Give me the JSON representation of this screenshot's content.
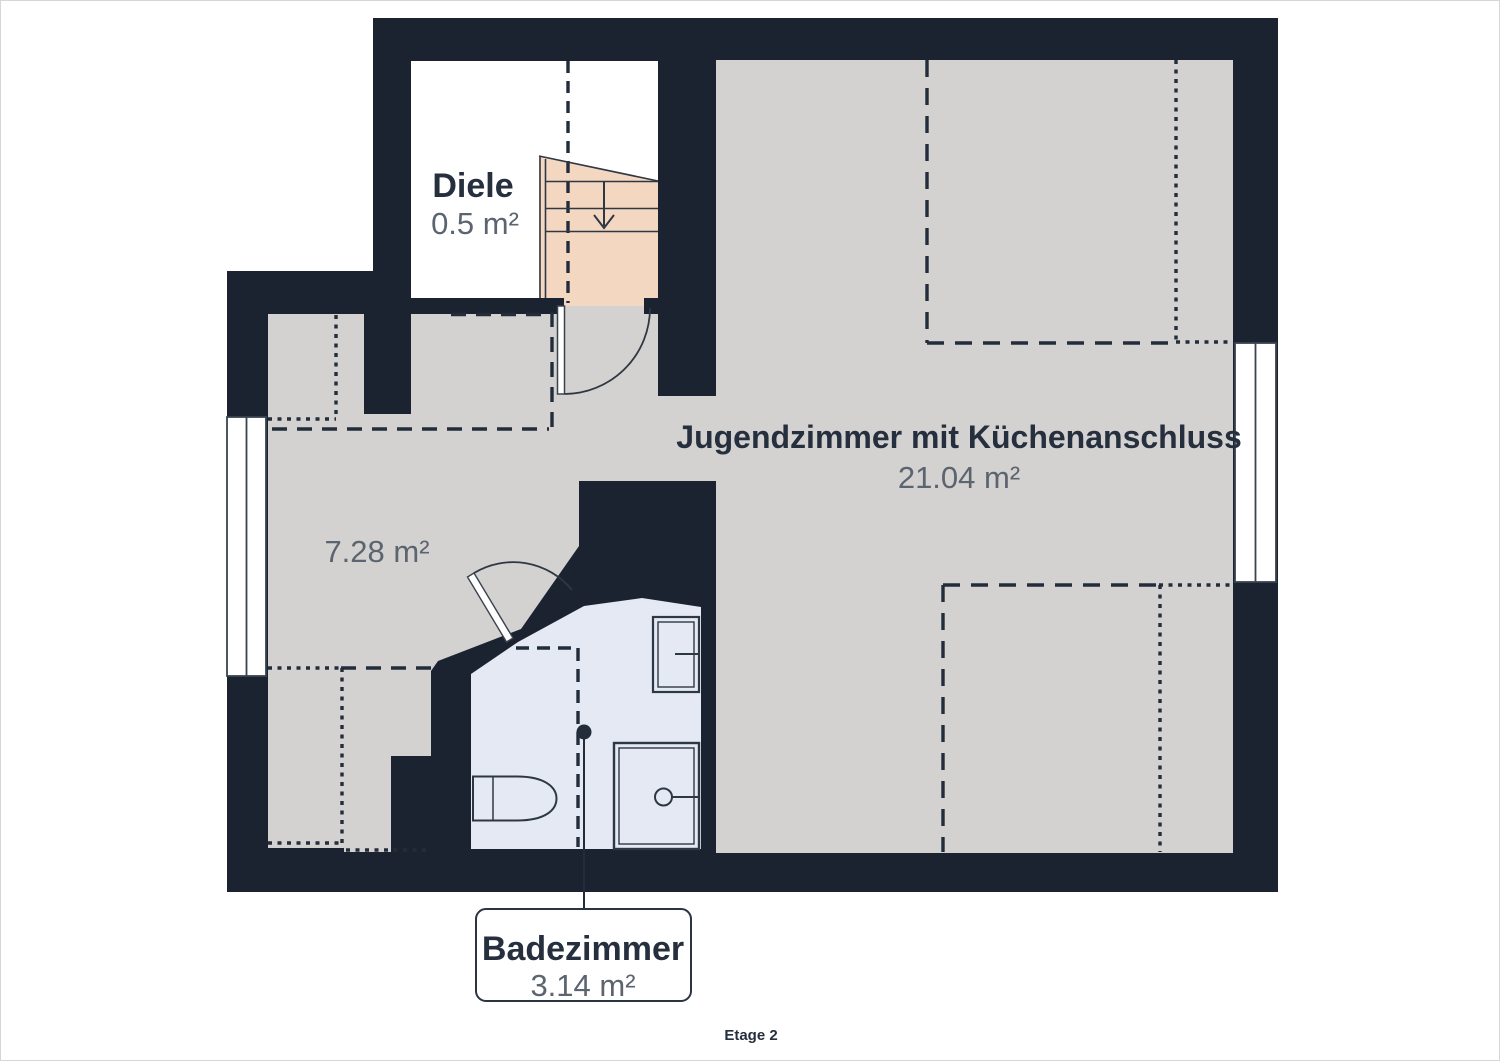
{
  "floor": {
    "label": "Etage 2"
  },
  "rooms": {
    "diele": {
      "name": "Diele",
      "area": "0.5 m²"
    },
    "jugendzimmer": {
      "name": "Jugendzimmer mit Küchenanschluss",
      "area": "21.04 m²"
    },
    "flur": {
      "area": "7.28 m²"
    },
    "badezimmer": {
      "name": "Badezimmer",
      "area": "3.14 m²"
    }
  },
  "colors": {
    "wall": "#1b2330",
    "floor_gray": "#d3d2d0",
    "stairs_peach": "#f4d7c0",
    "bathroom_blue": "#e4e9f4",
    "label_dark": "#262f3e",
    "label_gray": "#5c6470"
  }
}
